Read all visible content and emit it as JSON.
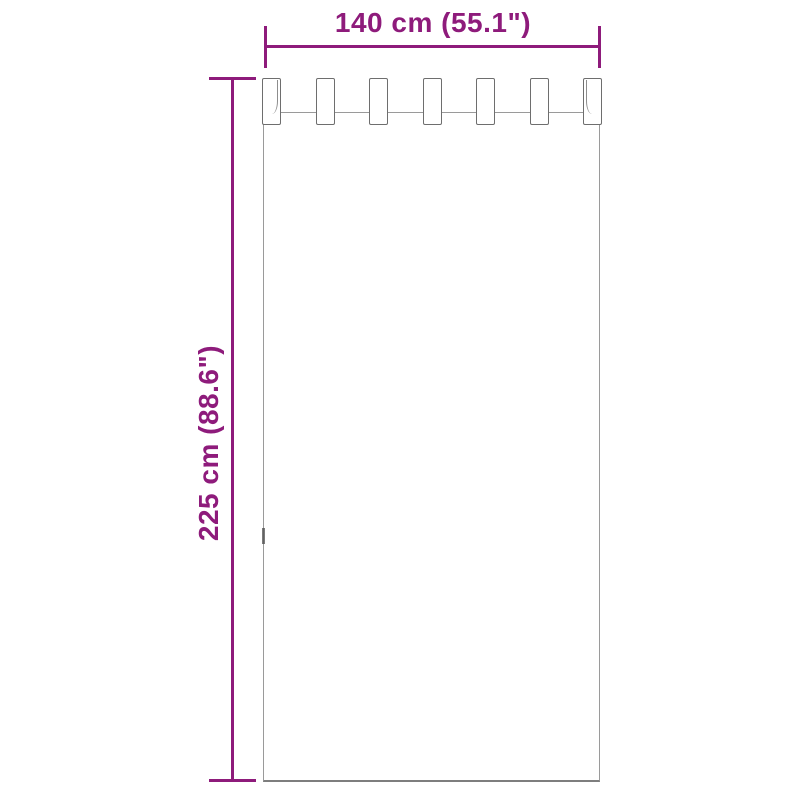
{
  "diagram": {
    "type": "product-dimension-diagram",
    "subject": "tab-top curtain panel",
    "width_label": "140 cm (55.1\")",
    "height_label": "225 cm (88.6\")",
    "tab_count": 7,
    "colors": {
      "dimension": "#8e1b7b",
      "outline": "#9a9a9a",
      "background": "#ffffff"
    }
  }
}
